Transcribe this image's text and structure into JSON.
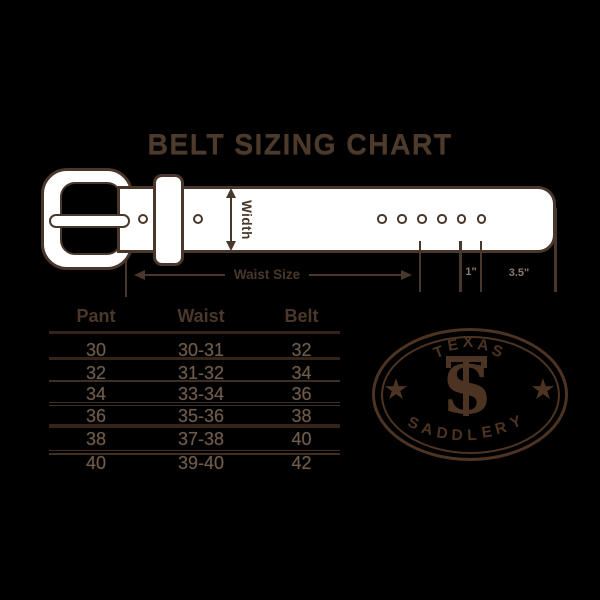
{
  "title": "BELT SIZING CHART",
  "colors": {
    "background": "#000000",
    "artwork_brown": "#4a372b",
    "belt_fill": "#ffffff",
    "table_value_brown": "#715c4b",
    "dim_label_gray": "#8b7c70",
    "logo_brown": "#4c3322"
  },
  "diagram": {
    "width_label": "Width",
    "waist_size_label": "Waist Size",
    "hole_gap_label": "1\"",
    "tip_length_label": "3.5\""
  },
  "table": {
    "headers": [
      "Pant",
      "Waist",
      "Belt"
    ],
    "rows": [
      [
        "30",
        "30-31",
        "32"
      ],
      [
        "32",
        "31-32",
        "34"
      ],
      [
        "34",
        "33-34",
        "36"
      ],
      [
        "36",
        "35-36",
        "38"
      ],
      [
        "38",
        "37-38",
        "40"
      ],
      [
        "40",
        "39-40",
        "42"
      ]
    ]
  },
  "logo": {
    "top_text": "TEXAS",
    "bottom_text": "SADDLERY",
    "monogram": "TS",
    "top_letters": [
      "T",
      "E",
      "X",
      "A",
      "S"
    ],
    "bottom_letters": [
      "S",
      "A",
      "D",
      "D",
      "L",
      "E",
      "R",
      "Y"
    ],
    "star": "★"
  }
}
